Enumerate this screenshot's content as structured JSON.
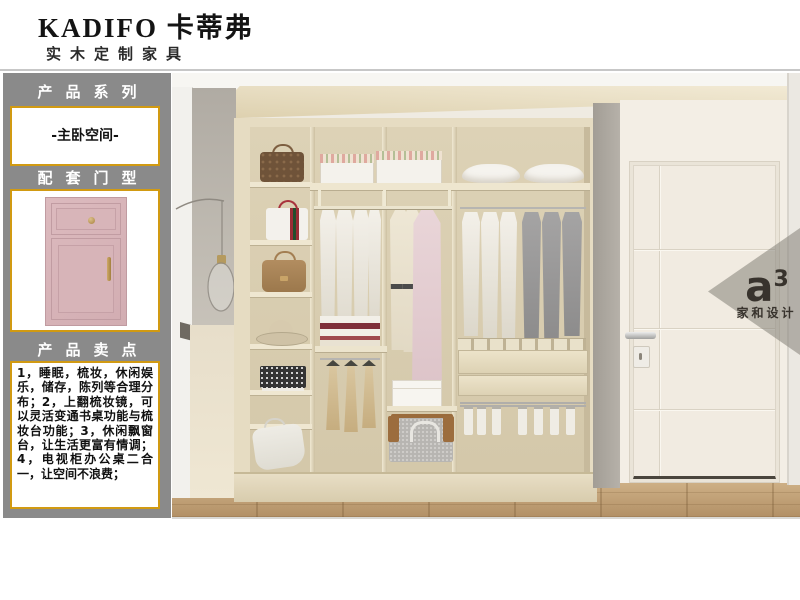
{
  "header": {
    "brand": "KADIFO 卡蒂弗",
    "tagline": "实木定制家具"
  },
  "sidebar": {
    "background_color": "#8a8a8a",
    "accent_border_color": "#d19a12",
    "section1_title": "产品系列",
    "series_name": "-主卧空间-",
    "section2_title": "配套门型",
    "door_swatch_color": "#d8b5b9",
    "section3_title": "产品卖点",
    "selling_points": [
      "1，睡眠，梳妆，休闲娱乐，储存，陈列等合理分布；",
      "2，上翻梳妆镜，可以灵活变通书桌功能与梳妆台功能；",
      "3，休闲飘窗台，让生活更富有情调；",
      "4，电视柜办公桌二合一，让空间不浪费；"
    ]
  },
  "watermark": {
    "logo_main": "a",
    "logo_sup": "3",
    "brand_cn": "家和设计"
  }
}
